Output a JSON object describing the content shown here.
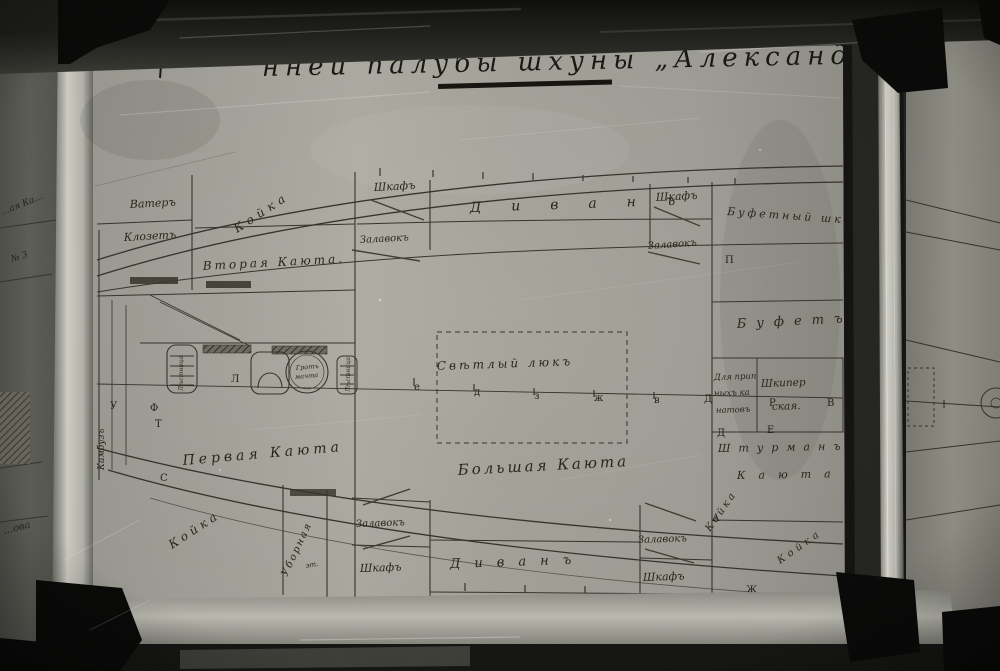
{
  "meta": {
    "sheet_color": "#aaa9a0",
    "ink_color": "#34322a",
    "frame_dark": "#181816",
    "frame_bright": "#c7c7bf",
    "fragment_paper": "#8d8d85"
  },
  "title": {
    "text": "нней палубы шхуны „Александръ“",
    "underline": "true"
  },
  "labels": [
    {
      "t": "Ватеръ",
      "x": 130,
      "y": 208,
      "r": -3,
      "fs": 11
    },
    {
      "t": "Клозетъ",
      "x": 124,
      "y": 241,
      "r": -3,
      "fs": 11
    },
    {
      "t": "Койка",
      "x": 237,
      "y": 233,
      "r": -33,
      "fs": 12,
      "ls": 5
    },
    {
      "t": "Вторая Каюта.",
      "x": 203,
      "y": 270,
      "r": -3,
      "fs": 12,
      "ls": 3
    },
    {
      "t": "Шкафъ",
      "x": 374,
      "y": 191,
      "r": -3,
      "fs": 11
    },
    {
      "t": "Залавокъ",
      "x": 360,
      "y": 243,
      "r": -3,
      "fs": 10
    },
    {
      "t": "Диванъ",
      "x": 470,
      "y": 212,
      "r": -2,
      "fs": 14,
      "ls": 30
    },
    {
      "t": "Шкафъ",
      "x": 656,
      "y": 201,
      "r": -3,
      "fs": 11
    },
    {
      "t": "Залавокъ",
      "x": 648,
      "y": 249,
      "r": -4,
      "fs": 10
    },
    {
      "t": "Буфетный шк.",
      "x": 727,
      "y": 215,
      "r": 4,
      "fs": 11,
      "ls": 3
    },
    {
      "t": "Буфетъ",
      "x": 737,
      "y": 328,
      "r": -3,
      "fs": 13,
      "ls": 10
    },
    {
      "t": "Свѣтлый люкъ",
      "x": 437,
      "y": 370,
      "r": -2,
      "fs": 12,
      "ls": 3
    },
    {
      "t": "Для прип",
      "x": 714,
      "y": 380,
      "r": -2,
      "fs": 8.5
    },
    {
      "t": "ныхъ ка",
      "x": 714,
      "y": 396,
      "r": -2,
      "fs": 8.5
    },
    {
      "t": "натовъ",
      "x": 716,
      "y": 413,
      "r": -2,
      "fs": 8.5
    },
    {
      "t": "Шкипер",
      "x": 761,
      "y": 387,
      "r": -2,
      "fs": 10.5
    },
    {
      "t": "ская.",
      "x": 772,
      "y": 410,
      "r": -2,
      "fs": 10.5
    },
    {
      "t": "Штурманъ",
      "x": 718,
      "y": 452,
      "r": -1,
      "fs": 11,
      "ls": 8
    },
    {
      "t": "Каюта",
      "x": 737,
      "y": 479,
      "r": -1,
      "fs": 11,
      "ls": 13
    },
    {
      "t": "Койка",
      "x": 710,
      "y": 532,
      "r": -55,
      "fs": 10,
      "ls": 3
    },
    {
      "t": "Койка",
      "x": 780,
      "y": 564,
      "r": -35,
      "fs": 10,
      "ls": 4
    },
    {
      "t": "Камбузъ",
      "x": 104,
      "y": 470,
      "r": -90,
      "fs": 9
    },
    {
      "t": "Первая Каюта",
      "x": 183,
      "y": 465,
      "r": -5,
      "fs": 14,
      "ls": 4
    },
    {
      "t": "Большая Каюта",
      "x": 458,
      "y": 475,
      "r": -3,
      "fs": 15,
      "ls": 3
    },
    {
      "t": "Койка",
      "x": 172,
      "y": 549,
      "r": -33,
      "fs": 12,
      "ls": 4
    },
    {
      "t": "Уборная",
      "x": 287,
      "y": 577,
      "r": -65,
      "fs": 10,
      "ls": 2
    },
    {
      "t": "эт.",
      "x": 306,
      "y": 568,
      "r": -10,
      "fs": 7
    },
    {
      "t": "Залавокъ",
      "x": 356,
      "y": 527,
      "r": -2,
      "fs": 10
    },
    {
      "t": "Шкафъ",
      "x": 360,
      "y": 572,
      "r": -2,
      "fs": 11
    },
    {
      "t": "Диванъ",
      "x": 450,
      "y": 568,
      "r": -2,
      "fs": 13,
      "ls": 14
    },
    {
      "t": "Залавокъ",
      "x": 638,
      "y": 543,
      "r": -2,
      "fs": 10
    },
    {
      "t": "Шкафъ",
      "x": 643,
      "y": 581,
      "r": -2,
      "fs": 11
    },
    {
      "t": "Гротъ",
      "x": 296,
      "y": 370,
      "r": -5,
      "fs": 6.5
    },
    {
      "t": "мачта",
      "x": 295,
      "y": 379,
      "r": -5,
      "fs": 6.5
    },
    {
      "t": "Лѣстница",
      "x": 350,
      "y": 392,
      "r": -90,
      "fs": 6
    },
    {
      "t": "Лѣстница",
      "x": 183,
      "y": 391,
      "r": -90,
      "fs": 6
    },
    {
      "t": "Койка",
      "x": 966,
      "y": 480,
      "r": -38,
      "fs": 10,
      "ls": 3
    },
    {
      "t": "Фокъ",
      "x": 986,
      "y": 401,
      "r": 0,
      "fs": 5.5
    },
    {
      "t": "мачта",
      "x": 985,
      "y": 408,
      "r": 0,
      "fs": 5.5
    },
    {
      "t": "…ая Ка…",
      "x": 2,
      "y": 215,
      "r": -22,
      "fs": 9,
      "cls": "frag"
    },
    {
      "t": "№ 3",
      "x": 12,
      "y": 262,
      "r": -18,
      "fs": 9,
      "cls": "frag"
    },
    {
      "t": "…ова",
      "x": 4,
      "y": 534,
      "r": -14,
      "fs": 10,
      "cls": "frag"
    }
  ],
  "station_letters": [
    {
      "t": "П",
      "x": 725,
      "y": 263
    },
    {
      "t": "Д",
      "x": 704,
      "y": 402
    },
    {
      "t": "Р",
      "x": 769,
      "y": 406
    },
    {
      "t": "В",
      "x": 827,
      "y": 406
    },
    {
      "t": "Д",
      "x": 717,
      "y": 436
    },
    {
      "t": "Е",
      "x": 767,
      "y": 433
    },
    {
      "t": "Л",
      "x": 231,
      "y": 382
    },
    {
      "t": "У",
      "x": 110,
      "y": 409
    },
    {
      "t": "Ф",
      "x": 150,
      "y": 411
    },
    {
      "t": "Т",
      "x": 155,
      "y": 427
    },
    {
      "t": "С",
      "x": 160,
      "y": 481
    },
    {
      "t": "А",
      "x": 712,
      "y": 521
    },
    {
      "t": "Б",
      "x": 711,
      "y": 601
    },
    {
      "t": "Ж",
      "x": 746,
      "y": 593
    },
    {
      "t": "М",
      "x": 944,
      "y": 411
    },
    {
      "t": "е",
      "x": 414,
      "y": 390
    },
    {
      "t": "д",
      "x": 474,
      "y": 395
    },
    {
      "t": "з",
      "x": 534,
      "y": 399
    },
    {
      "t": "ж",
      "x": 594,
      "y": 401
    },
    {
      "t": "в",
      "x": 654,
      "y": 403
    }
  ]
}
